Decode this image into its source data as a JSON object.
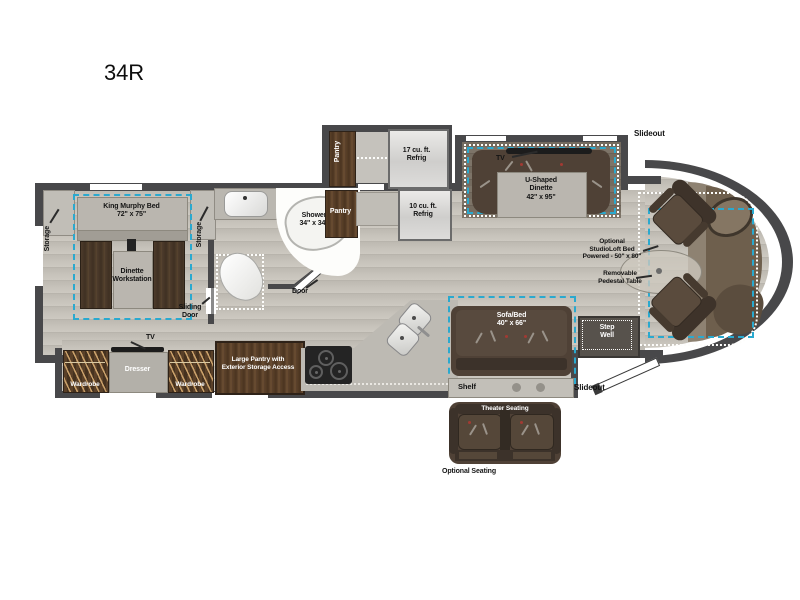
{
  "title": "34R",
  "labels": {
    "slideout_top": "Slideout",
    "slideout_bottom": "Slideout",
    "pantry_vertical": "Pantry",
    "refrig_17": "17 cu. ft.\nRefrig",
    "tv_dinette": "TV",
    "u_dinette": "U-Shaped\nDinette\n42\" x 95\"",
    "storage_left": "Storage",
    "storage_right": "Storage",
    "king_bed": "King Murphy Bed\n72\" x 75\"",
    "dinette_workstation": "Dinette\nWorkstation",
    "sliding_door": "Sliding\nDoor",
    "shower": "Shower\n34\" x 34\"",
    "pantry_bath": "Pantry",
    "refrig_10": "10 cu. ft.\nRefrig",
    "door": "Door",
    "studioloft_bed": "Optional\nStudioLoft Bed\nPowered - 50\" x 80\"",
    "pedestal_table": "Removable\nPedestal Table",
    "wardrobe_left": "Wardrobe",
    "dresser": "Dresser",
    "tv_bedroom": "TV",
    "wardrobe_right": "Wardrobe",
    "large_pantry": "Large Pantry with\nExterior Storage Access",
    "sofa_bed": "Sofa/Bed\n40\" x 66\"",
    "shelf": "Shelf",
    "step_well": "Step\nWell",
    "theater_seating": "Theater Seating",
    "optional_seating": "Optional Seating"
  },
  "colors": {
    "wall": "#48484a",
    "slideout_dash": "#2aa9cf",
    "floor_wood": "#c6c2ba",
    "cabinet_wood": "#553c28",
    "upholstery_brown": "#4f4136"
  }
}
